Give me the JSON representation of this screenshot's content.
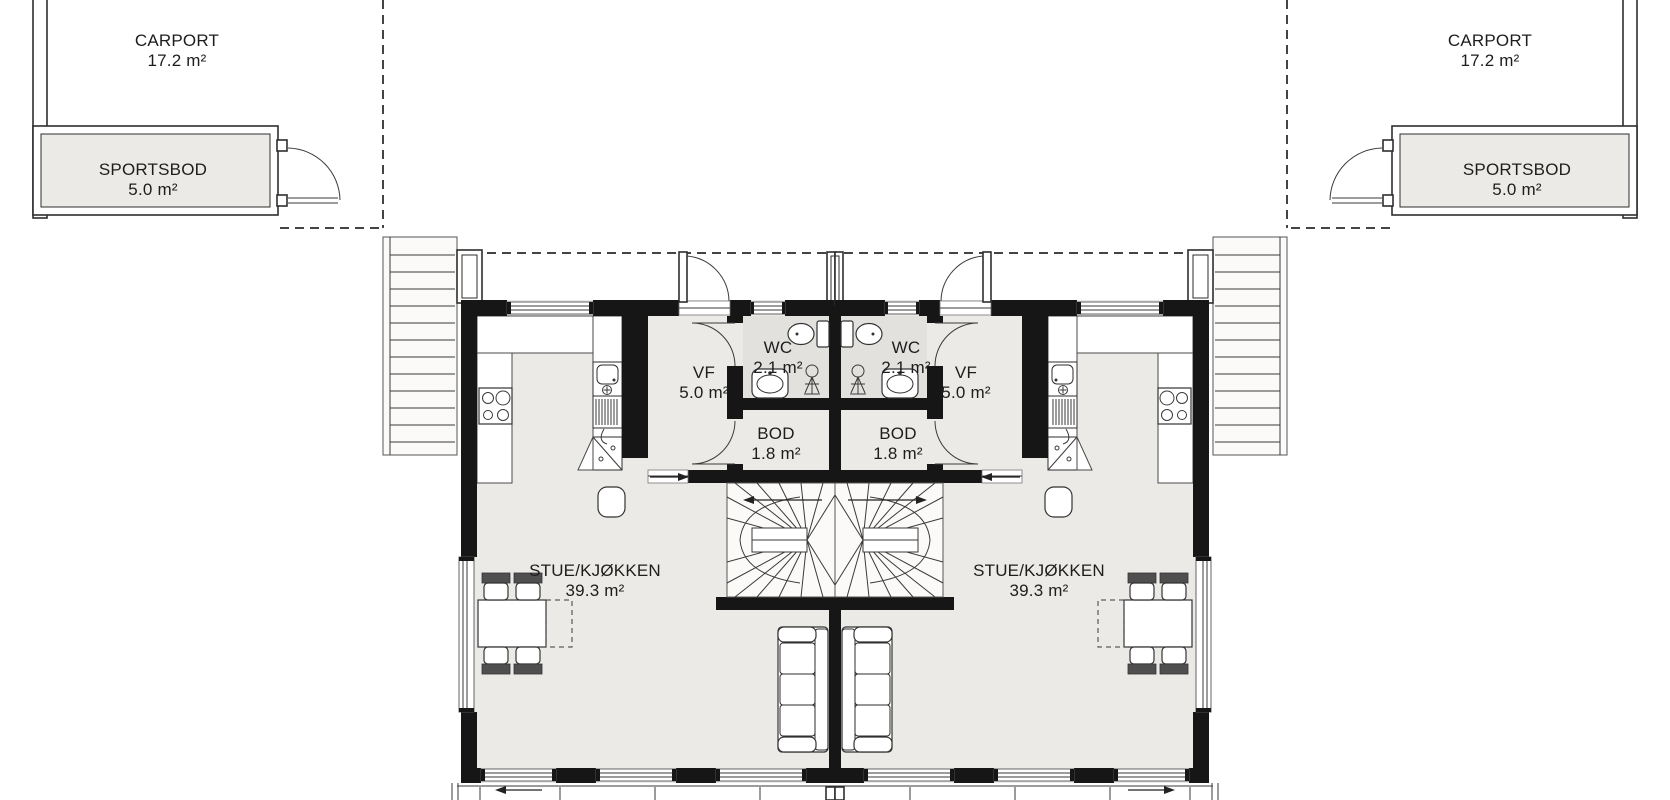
{
  "rooms": {
    "carport_left": {
      "name": "CARPORT",
      "area": "17.2 m²"
    },
    "carport_right": {
      "name": "CARPORT",
      "area": "17.2 m²"
    },
    "sportsbod_left": {
      "name": "SPORTSBOD",
      "area": "5.0 m²"
    },
    "sportsbod_right": {
      "name": "SPORTSBOD",
      "area": "5.0 m²"
    },
    "vf_left": {
      "name": "VF",
      "area": "5.0 m²"
    },
    "vf_right": {
      "name": "VF",
      "area": "5.0 m²"
    },
    "wc_left": {
      "name": "WC",
      "area": "2.1 m²"
    },
    "wc_right": {
      "name": "WC",
      "area": "2.1 m²"
    },
    "bod_left": {
      "name": "BOD",
      "area": "1.8 m²"
    },
    "bod_right": {
      "name": "BOD",
      "area": "1.8 m²"
    },
    "stue_left": {
      "name": "STUE/KJØKKEN",
      "area": "39.3 m²"
    },
    "stue_right": {
      "name": "STUE/KJØKKEN",
      "area": "39.3 m²"
    }
  },
  "colors": {
    "wall": "#161616",
    "floor": "#eceae6",
    "wc_floor": "#e2e1de",
    "line": "#3a3a3a"
  }
}
